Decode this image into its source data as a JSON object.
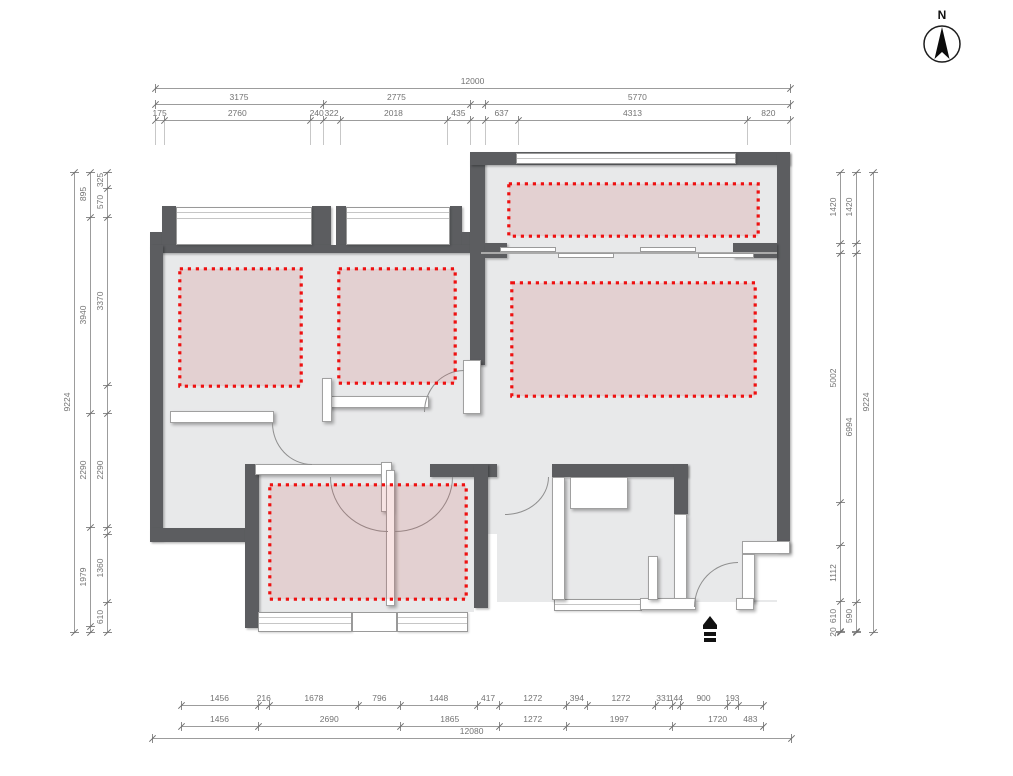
{
  "compass": {
    "north_label": "N"
  },
  "plan": {
    "colors": {
      "wall": "#5c5d60",
      "floor": "#e8e9ea",
      "highlight_border": "#ee1111",
      "highlight_fill": "rgba(205,80,80,0.16)"
    },
    "highlight_zones": [
      {
        "name": "zone-bedroom-left",
        "x": 178,
        "y": 267,
        "w": 125,
        "h": 121
      },
      {
        "name": "zone-bedroom-middle",
        "x": 337,
        "y": 267,
        "w": 120,
        "h": 118
      },
      {
        "name": "zone-balcony",
        "x": 507,
        "y": 182,
        "w": 253,
        "h": 56
      },
      {
        "name": "zone-living-room",
        "x": 510,
        "y": 281,
        "w": 247,
        "h": 117
      },
      {
        "name": "zone-bottom-rooms",
        "x": 268,
        "y": 483,
        "w": 200,
        "h": 118
      }
    ]
  },
  "dimensions": {
    "scale_px_per_mm_h": 0.05292,
    "scale_px_per_mm_v": 0.04988,
    "rows": [
      {
        "o": "h",
        "x": 155,
        "y": 88,
        "segs": [
          {
            "v": 12000
          }
        ]
      },
      {
        "o": "h",
        "x": 155,
        "y": 104,
        "segs": [
          {
            "v": 3175
          },
          {
            "v": 2775
          },
          {
            "g": 280
          },
          {
            "v": 5770
          }
        ]
      },
      {
        "o": "h",
        "x": 155,
        "y": 120,
        "ext": 24,
        "segs": [
          {
            "v": 175
          },
          {
            "v": 2760
          },
          {
            "v": 240
          },
          {
            "v": 322
          },
          {
            "v": 2018
          },
          {
            "v": 435
          },
          {
            "g": 280
          },
          {
            "v": 637
          },
          {
            "v": 4313
          },
          {
            "v": 820
          }
        ]
      },
      {
        "o": "h",
        "x": 181,
        "y": 705,
        "segs": [
          {
            "v": 1456
          },
          {
            "v": 216
          },
          {
            "v": 1678
          },
          {
            "v": 796
          },
          {
            "v": 1448
          },
          {
            "v": 417
          },
          {
            "v": 1272
          },
          {
            "v": 394
          },
          {
            "v": 1272
          },
          {
            "v": 331
          },
          {
            "v": 144
          },
          {
            "v": 900
          },
          {
            "v": 193
          },
          {
            "v": 483,
            "dy": 10
          }
        ]
      },
      {
        "o": "h",
        "x": 181,
        "y": 726,
        "segs": [
          {
            "v": 1456
          },
          {
            "v": 2690
          },
          {
            "v": 1865
          },
          {
            "v": 1272
          },
          {
            "v": 1997
          },
          {
            "v": 1720
          }
        ]
      },
      {
        "o": "h",
        "x": 152,
        "y": 738,
        "segs": [
          {
            "v": 12080
          }
        ]
      },
      {
        "o": "v",
        "x": 74,
        "y": 172,
        "segs": [
          {
            "v": 9224
          }
        ]
      },
      {
        "o": "v",
        "x": 90,
        "y": 172,
        "segs": [
          {
            "v": 895
          },
          {
            "v": 3940
          },
          {
            "v": 2290
          },
          {
            "v": 1979
          },
          {
            "g": 120
          }
        ]
      },
      {
        "o": "v",
        "x": 107,
        "y": 172,
        "segs": [
          {
            "v": 325
          },
          {
            "v": 570
          },
          {
            "v": 3370
          },
          {
            "g": 570
          },
          {
            "v": 2290
          },
          {
            "g": 129
          },
          {
            "v": 1360
          },
          {
            "v": 610
          }
        ]
      },
      {
        "o": "v",
        "x": 840,
        "y": 172,
        "segs": [
          {
            "v": 1420
          },
          {
            "g": 200
          },
          {
            "v": 5002
          },
          {
            "g": 860
          },
          {
            "v": 1112
          },
          {
            "v": 610
          },
          {
            "v": 20
          }
        ]
      },
      {
        "o": "v",
        "x": 856,
        "y": 172,
        "segs": [
          {
            "v": 1420
          },
          {
            "g": 200
          },
          {
            "v": 6994
          },
          {
            "v": 590
          },
          {
            "g": 20
          }
        ]
      },
      {
        "o": "v",
        "x": 873,
        "y": 172,
        "segs": [
          {
            "v": 9224
          }
        ]
      }
    ]
  }
}
